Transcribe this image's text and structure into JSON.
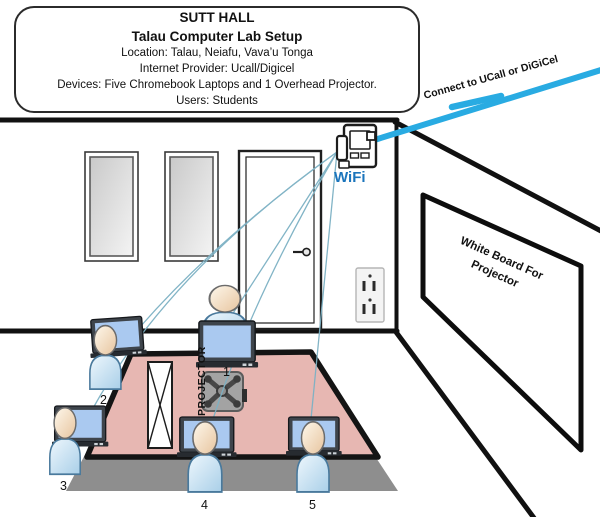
{
  "title_box": {
    "hall": "SUTT HALL",
    "title": "Talau Computer Lab Setup",
    "location": "Location: Talau, Neiafu, Vava’u Tonga",
    "provider": "Internet Provider: Ucall/Digicel",
    "devices": "Devices: Five Chromebook Laptops and 1 Overhead Projector.",
    "users": "Users: Students"
  },
  "labels": {
    "connection": "Connect to UCall or DiGiCel",
    "wifi": "WiFi",
    "whiteboard": "White Board For Projector",
    "projector": "PROJECTOR"
  },
  "stations": [
    {
      "number": "1"
    },
    {
      "number": "2"
    },
    {
      "number": "3"
    },
    {
      "number": "4"
    },
    {
      "number": "5"
    }
  ],
  "icons": {
    "wifi_router": "router-box-with-dongle",
    "student": "person-figure",
    "laptop": "chromebook-laptop",
    "projector": "ceiling-mount-projector",
    "outlet": "duplex-power-outlet",
    "door": "door-with-knob",
    "window": "double-frame-window",
    "divider": "x-braced-panel",
    "internet_line": "thick-blue-line-with-break",
    "wifi_links": "thin-teal-curves"
  },
  "colors": {
    "internet_line": "#29abe2",
    "wifi_link_line": "#7cb1c4",
    "floor": "#e7b7b2",
    "floor_shadow": "#8e8e8e",
    "wall_line": "#111111",
    "wifi_text": "#1b75bc",
    "laptop_screen": "#aac9f0",
    "student_body": "#a9cfe8",
    "student_head": "#e7c49e"
  }
}
